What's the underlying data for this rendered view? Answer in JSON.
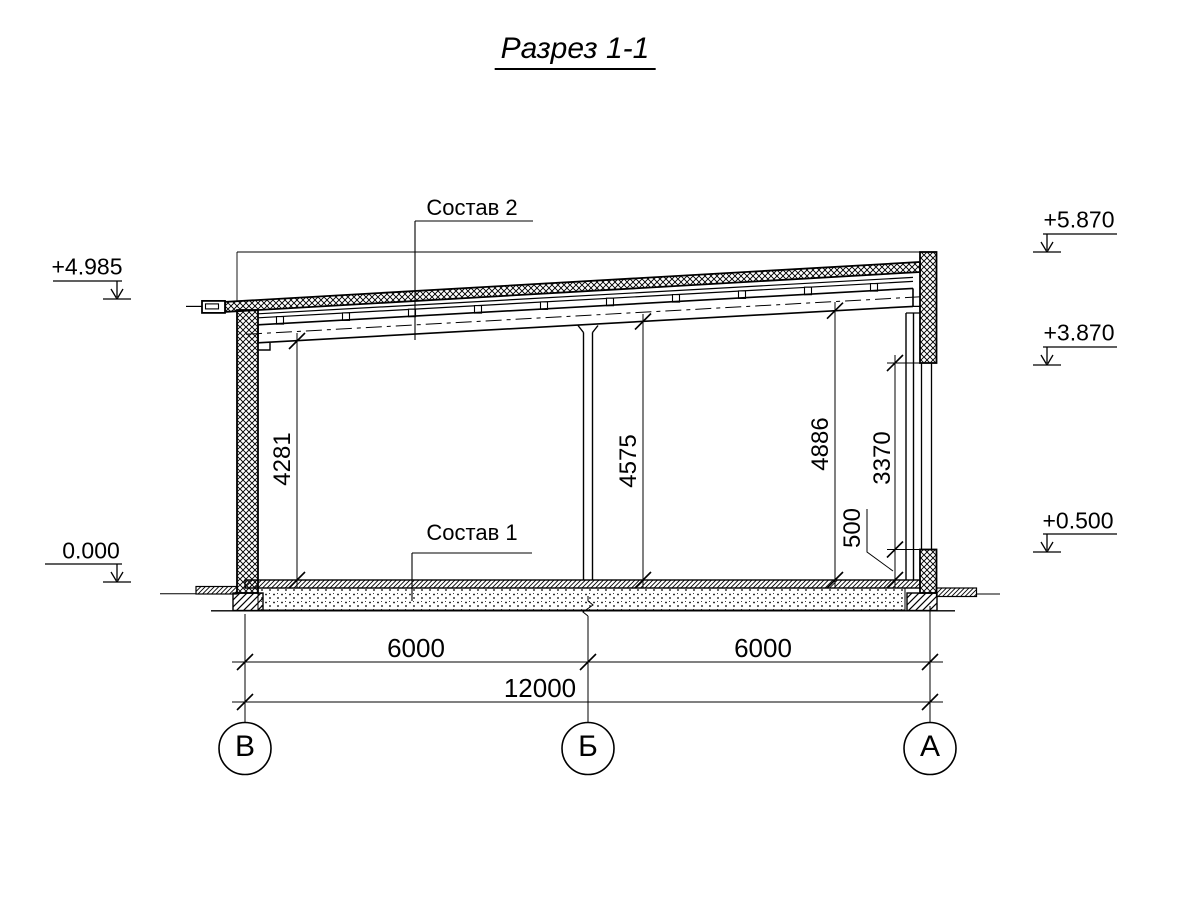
{
  "background": "#ffffff",
  "line_color": "#000000",
  "title": "Разрез 1-1",
  "callouts": {
    "roof_assembly": "Состав 2",
    "floor_assembly": "Состав 1"
  },
  "elevations": {
    "roof_edge_left": "+4.985",
    "floor_zero_left": "0.000",
    "parapet_top_right": "+5.870",
    "opening_top_right": "+3.870",
    "sill_right": "+0.500"
  },
  "dims": {
    "height_left": "4281",
    "height_middle": "4575",
    "height_right": "4886",
    "opening_height": "3370",
    "sill_height": "500",
    "span_left": "6000",
    "span_right": "6000",
    "span_total": "12000"
  },
  "axes": {
    "v": "В",
    "b": "Б",
    "a": "А"
  }
}
